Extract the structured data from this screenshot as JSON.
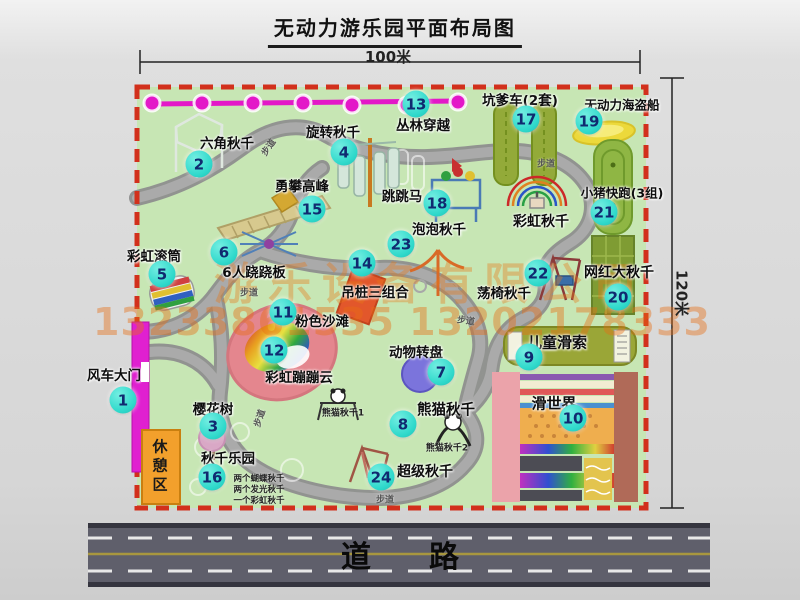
{
  "title": "无动力游乐园平面布局图",
  "dimensions": {
    "width_label": "100米",
    "height_label": "120米"
  },
  "road": {
    "label": "道路"
  },
  "watermark": {
    "company": "游乐设备有限公司",
    "phone": "13233861535 13202178333"
  },
  "rest_area": {
    "label": "休憩区"
  },
  "colors": {
    "park_green": "#c7e6b4",
    "border_red": "#d2301c",
    "badge_teal": "#2fd9cb",
    "path_gray": "#a2a2a2",
    "zipline_magenta": "#e318c8",
    "gate_magenta": "#e020d0",
    "rest_orange": "#f2a02c",
    "road_gray": "#5f5f6b",
    "watermark_orange": "#e87818"
  },
  "attractions": [
    {
      "n": "1",
      "label": "风车大门",
      "lx": 114,
      "ly": 374,
      "bx": 123,
      "by": 400
    },
    {
      "n": "2",
      "label": "六角秋千",
      "lx": 227,
      "ly": 142,
      "bx": 199,
      "by": 164
    },
    {
      "n": "3",
      "label": "樱花树",
      "lx": 213,
      "ly": 408,
      "bx": 213,
      "by": 426
    },
    {
      "n": "4",
      "label": "旋转秋千",
      "lx": 333,
      "ly": 131,
      "bx": 344,
      "by": 152
    },
    {
      "n": "5",
      "label": "彩虹滚筒",
      "lx": 154,
      "ly": 255,
      "bx": 162,
      "by": 274
    },
    {
      "n": "6",
      "label": "6人跷跷板",
      "lx": 254,
      "ly": 271,
      "bx": 224,
      "by": 252
    },
    {
      "n": "7",
      "label": "动物转盘",
      "lx": 416,
      "ly": 351,
      "bx": 441,
      "by": 372
    },
    {
      "n": "8",
      "label": "熊猫秋千",
      "lx": 446,
      "ly": 409,
      "bx": 403,
      "by": 424,
      "fs": 14.5
    },
    {
      "n": "9",
      "label": "儿童滑索",
      "lx": 557,
      "ly": 342,
      "bx": 529,
      "by": 357,
      "fs": 15
    },
    {
      "n": "10",
      "label": "滑世界",
      "lx": 554,
      "ly": 403,
      "bx": 573,
      "by": 418,
      "fs": 15
    },
    {
      "n": "11",
      "label": "粉色沙滩",
      "lx": 322,
      "ly": 320,
      "bx": 283,
      "by": 312
    },
    {
      "n": "12",
      "label": "彩虹蹦蹦云",
      "lx": 299,
      "ly": 376,
      "bx": 274,
      "by": 350
    },
    {
      "n": "13",
      "label": "丛林穿越",
      "lx": 423,
      "ly": 124,
      "bx": 416,
      "by": 104
    },
    {
      "n": "14",
      "label": "吊桩三组合",
      "lx": 375,
      "ly": 291,
      "bx": 362,
      "by": 263
    },
    {
      "n": "15",
      "label": "勇攀高峰",
      "lx": 302,
      "ly": 185,
      "bx": 312,
      "by": 209
    },
    {
      "n": "16",
      "label": "秋千乐园",
      "lx": 228,
      "ly": 457,
      "bx": 212,
      "by": 477
    },
    {
      "n": "17",
      "label": "坑爹车(2套)",
      "lx": 520,
      "ly": 99,
      "bx": 526,
      "by": 119
    },
    {
      "n": "18",
      "label": "跳跳马",
      "lx": 402,
      "ly": 195,
      "bx": 437,
      "by": 203
    },
    {
      "n": "19",
      "label": "无动力海盗船",
      "lx": 622,
      "ly": 104,
      "bx": 589,
      "by": 121,
      "fs": 12.5
    },
    {
      "n": "20",
      "label": "网红大秋千",
      "lx": 619,
      "ly": 272,
      "bx": 618,
      "by": 297,
      "fs": 14
    },
    {
      "n": "21",
      "label": "小猪快跑(3组)",
      "lx": 622,
      "ly": 192,
      "bx": 604,
      "by": 212,
      "fs": 12.5
    },
    {
      "n": "22",
      "label": "荡椅秋千",
      "lx": 504,
      "ly": 292,
      "bx": 538,
      "by": 273
    },
    {
      "n": "23",
      "label": "泡泡秋千",
      "lx": 439,
      "ly": 228,
      "bx": 401,
      "by": 244
    },
    {
      "n": "24",
      "label": "超级秋千",
      "lx": 425,
      "ly": 471,
      "bx": 381,
      "by": 477,
      "fs": 14
    },
    {
      "n": "",
      "label": "彩虹秋千",
      "lx": 541,
      "ly": 221,
      "fs": 14
    }
  ],
  "path_labels": [
    {
      "t": "步道",
      "x": 268,
      "y": 147,
      "r": -55
    },
    {
      "t": "步道",
      "x": 546,
      "y": 163,
      "r": 0
    },
    {
      "t": "步道",
      "x": 249,
      "y": 292,
      "r": 0
    },
    {
      "t": "步道",
      "x": 466,
      "y": 320,
      "r": 8
    },
    {
      "t": "步道",
      "x": 259,
      "y": 418,
      "r": -72
    },
    {
      "t": "步道",
      "x": 385,
      "y": 499,
      "r": 0
    }
  ],
  "sub_labels": [
    {
      "t": "熊猫秋千1",
      "x": 343,
      "y": 412,
      "fs": 9
    },
    {
      "t": "熊猫秋千2",
      "x": 447,
      "y": 447,
      "fs": 9
    },
    {
      "t": "两个蝴蝶秋千",
      "x": 259,
      "y": 478,
      "fs": 8.5
    },
    {
      "t": "两个发光秋千",
      "x": 259,
      "y": 489,
      "fs": 8.5
    },
    {
      "t": "一个彩虹秋千",
      "x": 259,
      "y": 500,
      "fs": 8.5
    }
  ]
}
